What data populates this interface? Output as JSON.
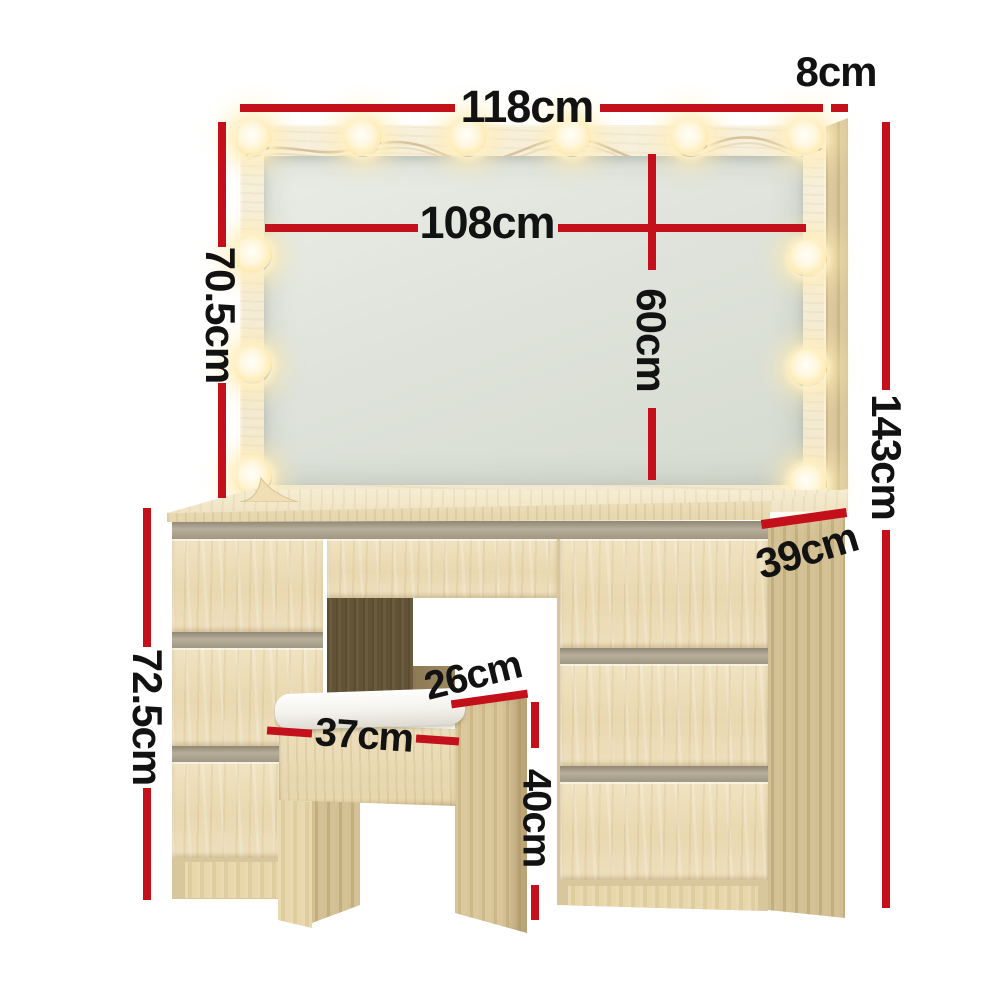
{
  "scene": {
    "background": "#ffffff",
    "bulb_count": 12
  },
  "annotations": {
    "mirror_width": "118cm",
    "frame_depth": "8cm",
    "mirror_glass_width": "108cm",
    "mirror_height": "70.5cm",
    "mirror_glass_height": "60cm",
    "total_height": "143cm",
    "desk_depth": "39cm",
    "desk_height": "72.5cm",
    "stool_width": "37cm",
    "stool_depth": "26cm",
    "stool_height": "40cm"
  },
  "colors": {
    "dimension_red": "#c3101a",
    "label_text": "#121212",
    "wood_light": "#ecdcb7",
    "wood_side": "#d3c093",
    "wood_frame_pale": "#f5eed9",
    "kneehole_dark": "#605237",
    "drawer_gap_gray": "#a89f8c",
    "cushion_white": "#f6f5f0",
    "mirror_glass": "#e2e6df",
    "bulb_glow": "#ffeab0"
  }
}
